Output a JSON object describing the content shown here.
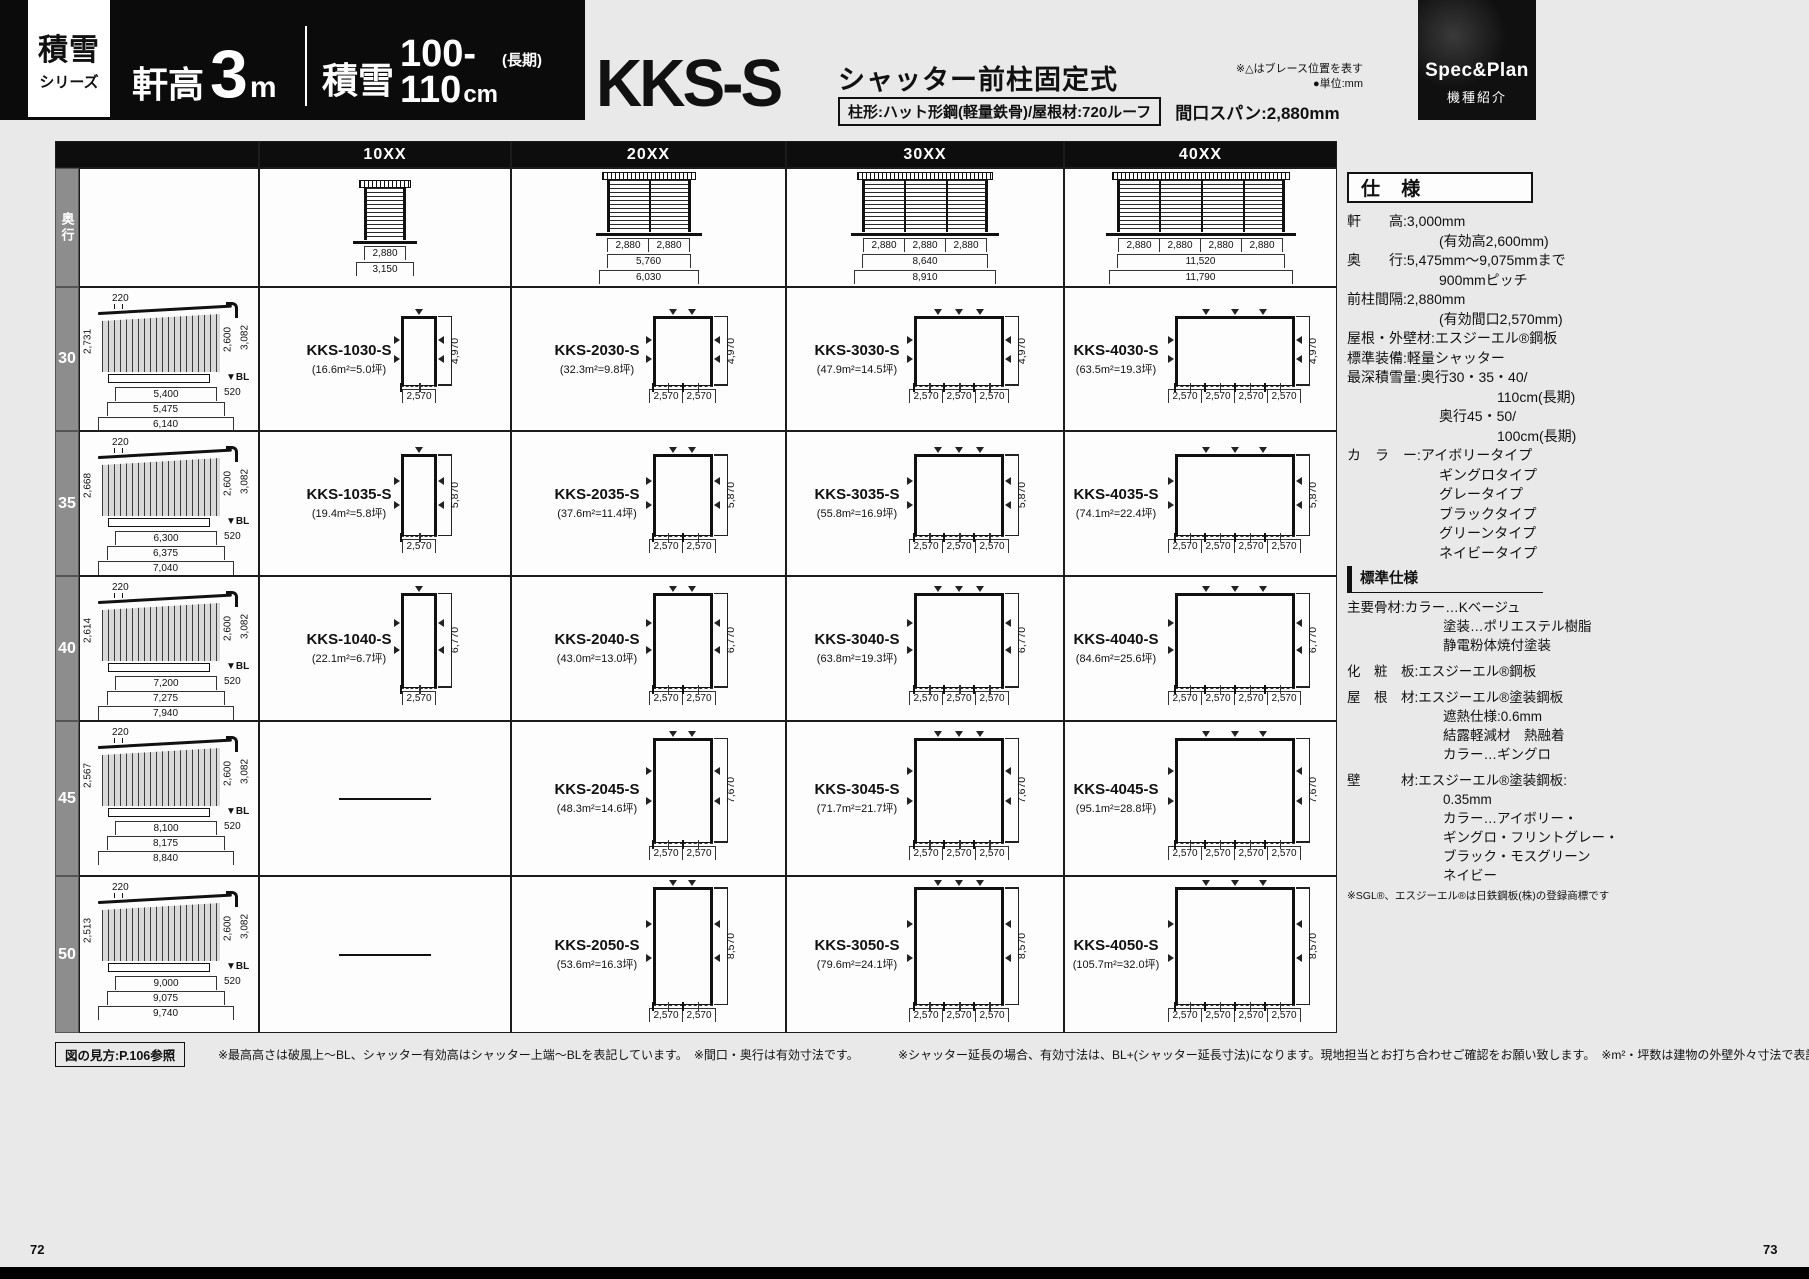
{
  "page": {
    "left_page_number": "72",
    "right_page_number": "73",
    "bg_color": "#e9e9e9",
    "accent_black": "#0d0d0d",
    "row_label_gray": "#8d8d8d"
  },
  "header": {
    "series_badge": {
      "line1": "積雪",
      "line2": "シリーズ"
    },
    "eave": {
      "label": "軒高",
      "value": "3",
      "unit": "m"
    },
    "snow": {
      "label": "積雪",
      "value_top": "100-",
      "value_bottom": "110",
      "unit": "cm",
      "term_note": "(長期)"
    },
    "model_code": "KKS-S",
    "product_title": "シャッター前柱固定式",
    "product_sub": "柱形:ハット形鋼(軽量鉄骨)/屋根材:720ルーフ",
    "span_note": "間口スパン:2,880mm",
    "legend_note1": "※△はブレース位置を表す",
    "legend_note2": "●単位:mm",
    "corner_badge": {
      "line1": "Spec&Plan",
      "line2": "機種紹介"
    }
  },
  "table": {
    "depth_axis_label": "奥行",
    "columns": [
      {
        "label": "10XX",
        "bays": 1,
        "bay_dims": [
          "2,880"
        ],
        "total1": null,
        "total2": "3,150"
      },
      {
        "label": "20XX",
        "bays": 2,
        "bay_dims": [
          "2,880",
          "2,880"
        ],
        "total1": "5,760",
        "total2": "6,030"
      },
      {
        "label": "30XX",
        "bays": 3,
        "bay_dims": [
          "2,880",
          "2,880",
          "2,880"
        ],
        "total1": "8,640",
        "total2": "8,910"
      },
      {
        "label": "40XX",
        "bays": 4,
        "bay_dims": [
          "2,880",
          "2,880",
          "2,880",
          "2,880"
        ],
        "total1": "11,520",
        "total2": "11,790"
      }
    ],
    "rows": [
      {
        "depth": "30",
        "side": {
          "overhang": "220",
          "left_height": "2,731",
          "shutter_height": "2,600",
          "max_height": "3,082",
          "bl_label": "▼BL",
          "base": "520",
          "w1": "5,400",
          "w2": "5,475",
          "w3": "6,140"
        },
        "cells": [
          {
            "model": "KKS-1030-S",
            "area": "(16.6m²=5.0坪)",
            "bays": 1,
            "bay_dim": "2,570",
            "depth_dim": "4,970"
          },
          {
            "model": "KKS-2030-S",
            "area": "(32.3m²=9.8坪)",
            "bays": 2,
            "bay_dim": "2,570",
            "depth_dim": "4,970"
          },
          {
            "model": "KKS-3030-S",
            "area": "(47.9m²=14.5坪)",
            "bays": 3,
            "bay_dim": "2,570",
            "depth_dim": "4,970"
          },
          {
            "model": "KKS-4030-S",
            "area": "(63.5m²=19.3坪)",
            "bays": 4,
            "bay_dim": "2,570",
            "depth_dim": "4,970"
          }
        ]
      },
      {
        "depth": "35",
        "side": {
          "overhang": "220",
          "left_height": "2,668",
          "shutter_height": "2,600",
          "max_height": "3,082",
          "bl_label": "▼BL",
          "base": "520",
          "w1": "6,300",
          "w2": "6,375",
          "w3": "7,040"
        },
        "cells": [
          {
            "model": "KKS-1035-S",
            "area": "(19.4m²=5.8坪)",
            "bays": 1,
            "bay_dim": "2,570",
            "depth_dim": "5,870"
          },
          {
            "model": "KKS-2035-S",
            "area": "(37.6m²=11.4坪)",
            "bays": 2,
            "bay_dim": "2,570",
            "depth_dim": "5,870"
          },
          {
            "model": "KKS-3035-S",
            "area": "(55.8m²=16.9坪)",
            "bays": 3,
            "bay_dim": "2,570",
            "depth_dim": "5,870"
          },
          {
            "model": "KKS-4035-S",
            "area": "(74.1m²=22.4坪)",
            "bays": 4,
            "bay_dim": "2,570",
            "depth_dim": "5,870"
          }
        ]
      },
      {
        "depth": "40",
        "side": {
          "overhang": "220",
          "left_height": "2,614",
          "shutter_height": "2,600",
          "max_height": "3,082",
          "bl_label": "▼BL",
          "base": "520",
          "w1": "7,200",
          "w2": "7,275",
          "w3": "7,940"
        },
        "cells": [
          {
            "model": "KKS-1040-S",
            "area": "(22.1m²=6.7坪)",
            "bays": 1,
            "bay_dim": "2,570",
            "depth_dim": "6,770"
          },
          {
            "model": "KKS-2040-S",
            "area": "(43.0m²=13.0坪)",
            "bays": 2,
            "bay_dim": "2,570",
            "depth_dim": "6,770"
          },
          {
            "model": "KKS-3040-S",
            "area": "(63.8m²=19.3坪)",
            "bays": 3,
            "bay_dim": "2,570",
            "depth_dim": "6,770"
          },
          {
            "model": "KKS-4040-S",
            "area": "(84.6m²=25.6坪)",
            "bays": 4,
            "bay_dim": "2,570",
            "depth_dim": "6,770"
          }
        ]
      },
      {
        "depth": "45",
        "side": {
          "overhang": "220",
          "left_height": "2,567",
          "shutter_height": "2,600",
          "max_height": "3,082",
          "bl_label": "▼BL",
          "base": "520",
          "w1": "8,100",
          "w2": "8,175",
          "w3": "8,840"
        },
        "cells": [
          null,
          {
            "model": "KKS-2045-S",
            "area": "(48.3m²=14.6坪)",
            "bays": 2,
            "bay_dim": "2,570",
            "depth_dim": "7,670"
          },
          {
            "model": "KKS-3045-S",
            "area": "(71.7m²=21.7坪)",
            "bays": 3,
            "bay_dim": "2,570",
            "depth_dim": "7,670"
          },
          {
            "model": "KKS-4045-S",
            "area": "(95.1m²=28.8坪)",
            "bays": 4,
            "bay_dim": "2,570",
            "depth_dim": "7,670"
          }
        ]
      },
      {
        "depth": "50",
        "side": {
          "overhang": "220",
          "left_height": "2,513",
          "shutter_height": "2,600",
          "max_height": "3,082",
          "bl_label": "▼BL",
          "base": "520",
          "w1": "9,000",
          "w2": "9,075",
          "w3": "9,740"
        },
        "cells": [
          null,
          {
            "model": "KKS-2050-S",
            "area": "(53.6m²=16.3坪)",
            "bays": 2,
            "bay_dim": "2,570",
            "depth_dim": "8,570"
          },
          {
            "model": "KKS-3050-S",
            "area": "(79.6m²=24.1坪)",
            "bays": 3,
            "bay_dim": "2,570",
            "depth_dim": "8,570"
          },
          {
            "model": "KKS-4050-S",
            "area": "(105.7m²=32.0坪)",
            "bays": 4,
            "bay_dim": "2,570",
            "depth_dim": "8,570"
          }
        ]
      }
    ]
  },
  "spec_panel": {
    "title": "仕 様",
    "lines": [
      {
        "text": "軒　　高:3,000mm",
        "ind": 0
      },
      {
        "text": "(有効高2,600mm)",
        "ind": 2
      },
      {
        "text": "奥　　行:5,475mm〜9,075mmまで",
        "ind": 0
      },
      {
        "text": "900mmピッチ",
        "ind": 2
      },
      {
        "text": "前柱間隔:2,880mm",
        "ind": 0
      },
      {
        "text": "(有効間口2,570mm)",
        "ind": 2
      },
      {
        "text": "屋根・外壁材:エスジーエル®鋼板",
        "ind": 0
      },
      {
        "text": "標準装備:軽量シャッター",
        "ind": 0
      },
      {
        "text": "最深積雪量:奥行30・35・40/",
        "ind": 0
      },
      {
        "text": "110cm(長期)",
        "ind": 3
      },
      {
        "text": "奥行45・50/",
        "ind": 2
      },
      {
        "text": "100cm(長期)",
        "ind": 3
      },
      {
        "text": "カ　ラ　ー:アイボリータイプ",
        "ind": 0
      },
      {
        "text": "ギングロタイプ",
        "ind": 2
      },
      {
        "text": "グレータイプ",
        "ind": 2
      },
      {
        "text": "ブラックタイプ",
        "ind": 2
      },
      {
        "text": "グリーンタイプ",
        "ind": 2
      },
      {
        "text": "ネイビータイプ",
        "ind": 2
      }
    ]
  },
  "standard_panel": {
    "title": "標準仕様",
    "lines": [
      {
        "text": "主要骨材:カラー…Kベージュ",
        "ind": 0
      },
      {
        "text": "塗装…ポリエステル樹脂",
        "ind": 2
      },
      {
        "text": "静電粉体焼付塗装",
        "ind": 2
      },
      {
        "text": "化　粧　板:エスジーエル®鋼板",
        "ind": 0,
        "gap": true
      },
      {
        "text": "屋　根　材:エスジーエル®塗装鋼板",
        "ind": 0,
        "gap": true
      },
      {
        "text": "遮熱仕様:0.6mm",
        "ind": 2
      },
      {
        "text": "結露軽減材　熱融着",
        "ind": 2
      },
      {
        "text": "カラー…ギングロ",
        "ind": 2
      },
      {
        "text": "壁　　　材:エスジーエル®塗装鋼板:",
        "ind": 0,
        "gap": true
      },
      {
        "text": "0.35mm",
        "ind": 2
      },
      {
        "text": "カラー…アイボリー・",
        "ind": 2
      },
      {
        "text": "ギングロ・フリントグレー・",
        "ind": 2
      },
      {
        "text": "ブラック・モスグリーン",
        "ind": 2
      },
      {
        "text": "ネイビー",
        "ind": 2
      }
    ],
    "trademark_note": "※SGL®、エスジーエル®は日鉄鋼板(株)の登録商標です"
  },
  "footnotes": {
    "map_ref": "図の見方:P.106参照",
    "note_left": "※最高高さは破風上〜BL、シャッター有効高はシャッター上端〜BLを表記しています。　※間口・奥行は有効寸法です。",
    "note_right": "※シャッター延長の場合、有効寸法は、BL+(シャッター延長寸法)になります。現地担当とお打ち合わせご確認をお願い致します。　※m²・坪数は建物の外壁外々寸法で表記しています。"
  }
}
